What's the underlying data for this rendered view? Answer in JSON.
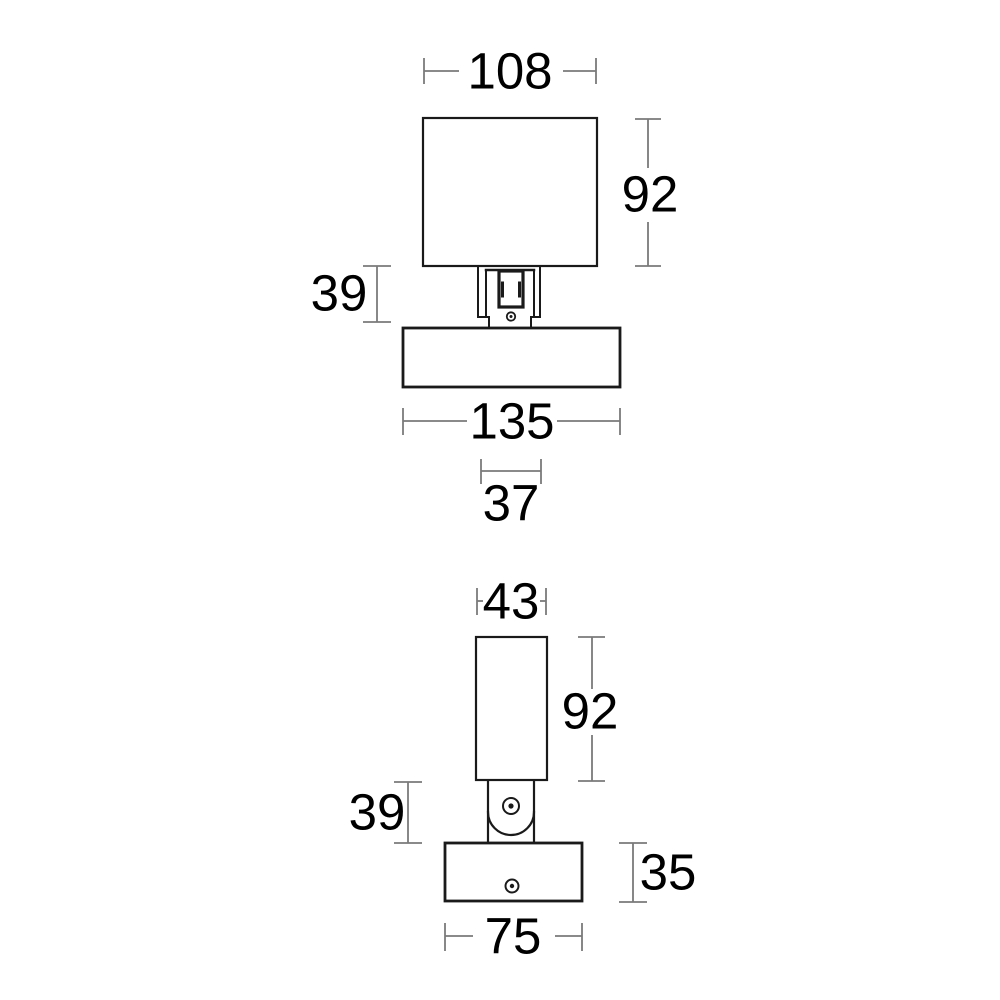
{
  "drawing": {
    "type": "technical-dimension-drawing",
    "subject": "adjustable wall spotlight, two orthographic views",
    "style": {
      "part_line_color": "#1a1a1a",
      "dimension_line_color": "#7a7a7a",
      "text_color": "#000000",
      "background_color": "#ffffff"
    },
    "views": [
      {
        "id": "front-view",
        "dimensions": [
          {
            "id": "shade-width",
            "value": "108"
          },
          {
            "id": "shade-height",
            "value": "92"
          },
          {
            "id": "mount-height",
            "value": "39"
          },
          {
            "id": "base-width",
            "value": "135"
          },
          {
            "id": "bracket-width",
            "value": "37"
          }
        ]
      },
      {
        "id": "side-view",
        "dimensions": [
          {
            "id": "body-width",
            "value": "43"
          },
          {
            "id": "body-height",
            "value": "92"
          },
          {
            "id": "joint-height",
            "value": "39"
          },
          {
            "id": "base-height",
            "value": "35"
          },
          {
            "id": "base-width",
            "value": "75"
          }
        ]
      }
    ]
  }
}
